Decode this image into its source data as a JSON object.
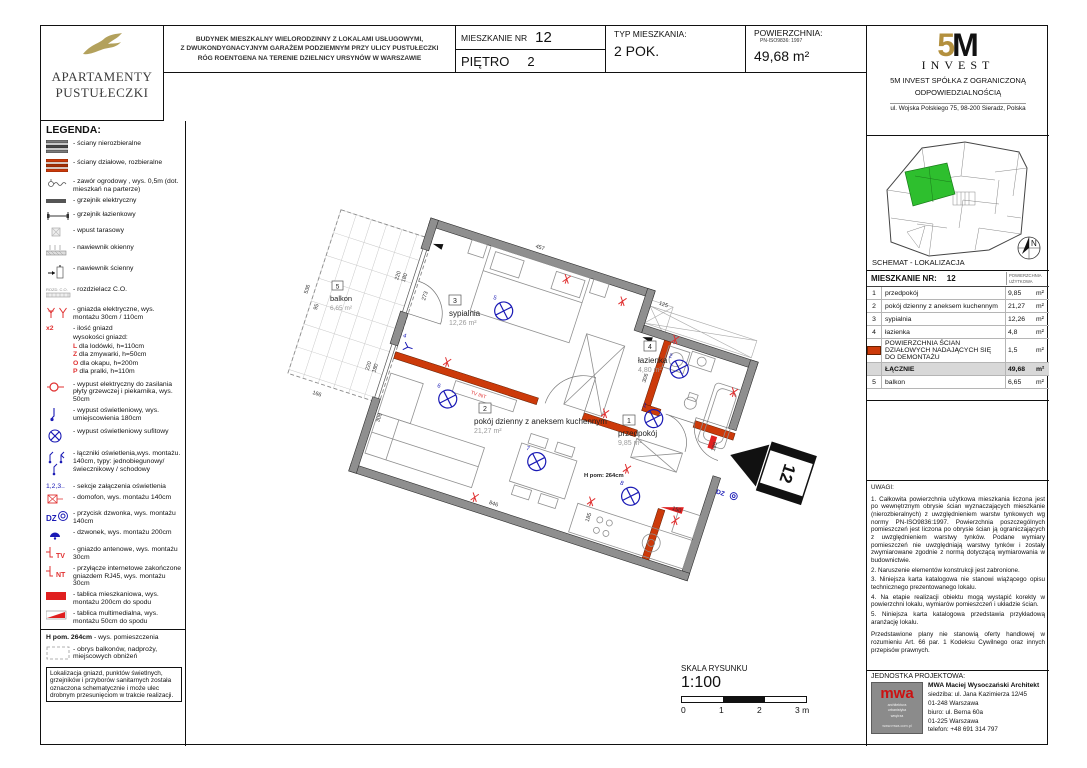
{
  "brand": {
    "line1": "APARTAMENTY",
    "line2": "PUSTUŁECZKI"
  },
  "header": {
    "desc_line1": "BUDYNEK MIESZKALNY WIELORODZINNY Z LOKALAMI USŁUGOWYMI,",
    "desc_line2": "Z DWUKONDYGNACYJNYM GARAŻEM PODZIEMNYM PRZY ULICY PUSTUŁECZKI",
    "desc_line3": "RÓG ROENTGENA NA TERENIE DZIELNICY URSYNÓW W WARSZAWIE",
    "apt_label": "MIESZKANIE NR",
    "apt_number": "12",
    "floor_label": "PIĘTRO",
    "floor_number": "2",
    "type_label": "TYP MIESZKANIA:",
    "type_value": "2 POK.",
    "area_label": "POWIERZCHNIA:",
    "area_norm": "PN-ISO9836: 1997",
    "area_value": "49,68  m²"
  },
  "developer": {
    "logo_5": "5",
    "logo_m": "M",
    "logo_invest": "INVEST",
    "line1": "5M INVEST  SPÓŁKA Z OGRANICZONĄ",
    "line2": "ODPOWIEDZIALNOŚCIĄ",
    "line3": "ul. Wojska Polskiego 75, 98-200 Sieradz, Polska"
  },
  "legend": {
    "title": "LEGENDA:",
    "rozd_label": "ROZD.  C.O.",
    "items": [
      {
        "text": "- ściany nierozbieralne"
      },
      {
        "text": "- ściany działowe, rozbieralne"
      },
      {
        "text": "- zawór ogrodowy , wys. 0,5m (dot. mieszkań na parterze)"
      },
      {
        "text": "- grzejnik elektryczny"
      },
      {
        "text": "- grzejnik łazienkowy"
      },
      {
        "text": "- wpust tarasowy"
      },
      {
        "text": "- nawiewnik okienny"
      },
      {
        "text": "- nawiewnik ścienny"
      },
      {
        "text": "- rozdzielacz C.O."
      },
      {
        "text": "- gniazda elektryczne, wys. montażu 30cm / 110cm"
      },
      {
        "pre": "x2",
        "lines": [
          "- ilość gniazd",
          "wysokości gniazd:",
          "L dla lodówki, h=110cm",
          "Z dla zmywarki, h=50cm",
          "O dla okapu,  h=200m",
          "P dla pralki, h=110m"
        ]
      },
      {
        "text": "- wypust elektryczny  do zasilania płyty grzewczej i piekarnika, wys. 50cm"
      },
      {
        "text": "- wypust oświetleniowy, wys. umiejscowienia 180cm"
      },
      {
        "text": "- wypust oświetleniowy sufitowy"
      },
      {
        "text": "- łączniki oświetlenia,wys. montażu. 140cm, typy: jednobiegunowy/ świecznikowy / schodowy"
      },
      {
        "pre": "1,2,3..",
        "text": "- sekcje załączenia oświetlenia"
      },
      {
        "text": "- domofon, wys. montażu 140cm"
      },
      {
        "pre": "DZ",
        "text": "- przycisk dzwonka, wys. montażu 140cm"
      },
      {
        "text": "- dzwonek, wys. montażu 200cm"
      },
      {
        "pre": "TV",
        "text": "- gniazdo antenowe, wys. montażu 30cm"
      },
      {
        "pre": "NT",
        "text": "- przyłącze internetowe zakończone gniazdem RJ45, wys. montażu 30cm"
      },
      {
        "text": "- tablica mieszkaniowa, wys. montażu 200cm do spodu"
      },
      {
        "text": "- tablica multimedialna, wys. montażu 50cm do spodu"
      },
      {
        "pre": "H pom. 264cm",
        "text": "- wys.  pomieszczenia"
      },
      {
        "text": "- obrys balkonów, nadproży,  miejscowych obniżeń"
      }
    ],
    "note": "Lokalizacja gniazd, punktów świetlnych, grzejników i przyborów sanitarnych została oznaczona schematycznie i może ulec drobnym przesunięciom w trakcie realizacji."
  },
  "location": {
    "title": "SCHEMAT - LOKALIZACJA",
    "north_label": "N",
    "unit_color": "#2ebf2e"
  },
  "unit_table": {
    "header": "MIESZKANIE NR:",
    "header_num": "12",
    "header_right": "POWIERZCHNIA UŻYTKOWA",
    "rows": [
      {
        "no": "1",
        "name": "przedpokój",
        "value": "9,85",
        "unit": "m²"
      },
      {
        "no": "2",
        "name": "pokój dzienny z aneksem kuchennym",
        "value": "21,27",
        "unit": "m²"
      },
      {
        "no": "3",
        "name": "sypialnia",
        "value": "12,26",
        "unit": "m²"
      },
      {
        "no": "4",
        "name": "łazienka",
        "value": "4,8",
        "unit": "m²"
      }
    ],
    "demontaz": {
      "name": "POWIERZCHNIA ŚCIAN DZIAŁOWYCH NADAJĄCYCH SIĘ DO DEMONTAŻU",
      "value": "1,5",
      "unit": "m²"
    },
    "total": {
      "name": "ŁĄCZNIE",
      "value": "49,68",
      "unit": "m²"
    },
    "balkon": {
      "no": "5",
      "name": "balkon",
      "value": "6,65",
      "unit": "m²"
    }
  },
  "uwagi": {
    "title": "UWAGI:",
    "items": [
      "1. Całkowita powierzchnia użytkowa mieszkania liczona jest po wewnętrznym obrysie ścian wyznaczających mieszkanie (nierozbieralnych) z uwzględnieniem warstw tynkowych wg normy PN-ISO9836:1997. Powierzchnia poszczególnych pomieszczeń jest liczona po obrysie ścian ją ograniczających z uwzględnieniem warstwy tynków. Podane wymiary pomieszczeń nie uwzględniają warstwy tynków i zostały zwymiarowane zgodnie z normą dotyczącą wymiarowania w budownictwie.",
      "2. Naruszenie elementów konstrukcji jest zabronione.",
      "3. Niniejsza karta katalogowa nie stanowi wiążącego opisu technicznego prezentowanego lokalu.",
      "4. Na etapie realizacji obiektu mogą wystąpić korekty w powierzchni lokalu, wymiarów pomieszczeń i układzie ścian.",
      "5. Niniejsza karta katalogowa przedstawia przykładową aranżację lokalu."
    ],
    "footer": "Przedstawione plany nie stanowią oferty handlowej w rozumieniu Art. 66 par. 1 Kodeksu Cywilnego oraz innych przepisów prawnych."
  },
  "jednostka": {
    "title": "JEDNOSTKA PROJEKTOWA:",
    "name": "MWA Maciej Wysoczański Architekt",
    "line1": "siedziba: ul. Jana Kazimierza 12/45",
    "line2": "01-248 Warszawa",
    "line3": "biuro: ul. Berna 60a",
    "line4": "01-225 Warszawa",
    "line5": "telefon: +48 691 314 797",
    "logo_text": "mwa",
    "logo_sub1": "architektura",
    "logo_sub2": "urbanistyka",
    "logo_sub3": "wnętrza",
    "logo_url": "www.mwa.com.pl"
  },
  "scale": {
    "label": "SKALA RYSUNKU",
    "ratio": "1:100",
    "tick0": "0",
    "tick1": "1",
    "tick2": "2",
    "tick3": "3 m"
  },
  "plan": {
    "rooms": [
      {
        "num": "3",
        "name": "sypialnia",
        "area": "12,26 m²"
      },
      {
        "num": "4",
        "name": "łazienka",
        "area": "4,80  m²"
      },
      {
        "num": "2",
        "name": "pokój dzienny z aneksem kuchennym",
        "area": "21,27 m²"
      },
      {
        "num": "1",
        "name": "przedpokój",
        "area": "9,85  m²"
      },
      {
        "num": "5",
        "name": "balkon",
        "area": "6,65  m²"
      }
    ],
    "dims": [
      "457",
      "125",
      "273",
      "306",
      "50",
      "180",
      "150",
      "846",
      "185",
      "308",
      "180",
      "220",
      "180",
      "220",
      "536",
      "95",
      "166"
    ],
    "light_ids": [
      "5",
      "6",
      "7",
      "8",
      "1",
      "2",
      "4"
    ],
    "height_note": "H pom: 264cm",
    "tv_note": "TV INT",
    "dz_label": "DZ",
    "entrance_number": "12"
  }
}
